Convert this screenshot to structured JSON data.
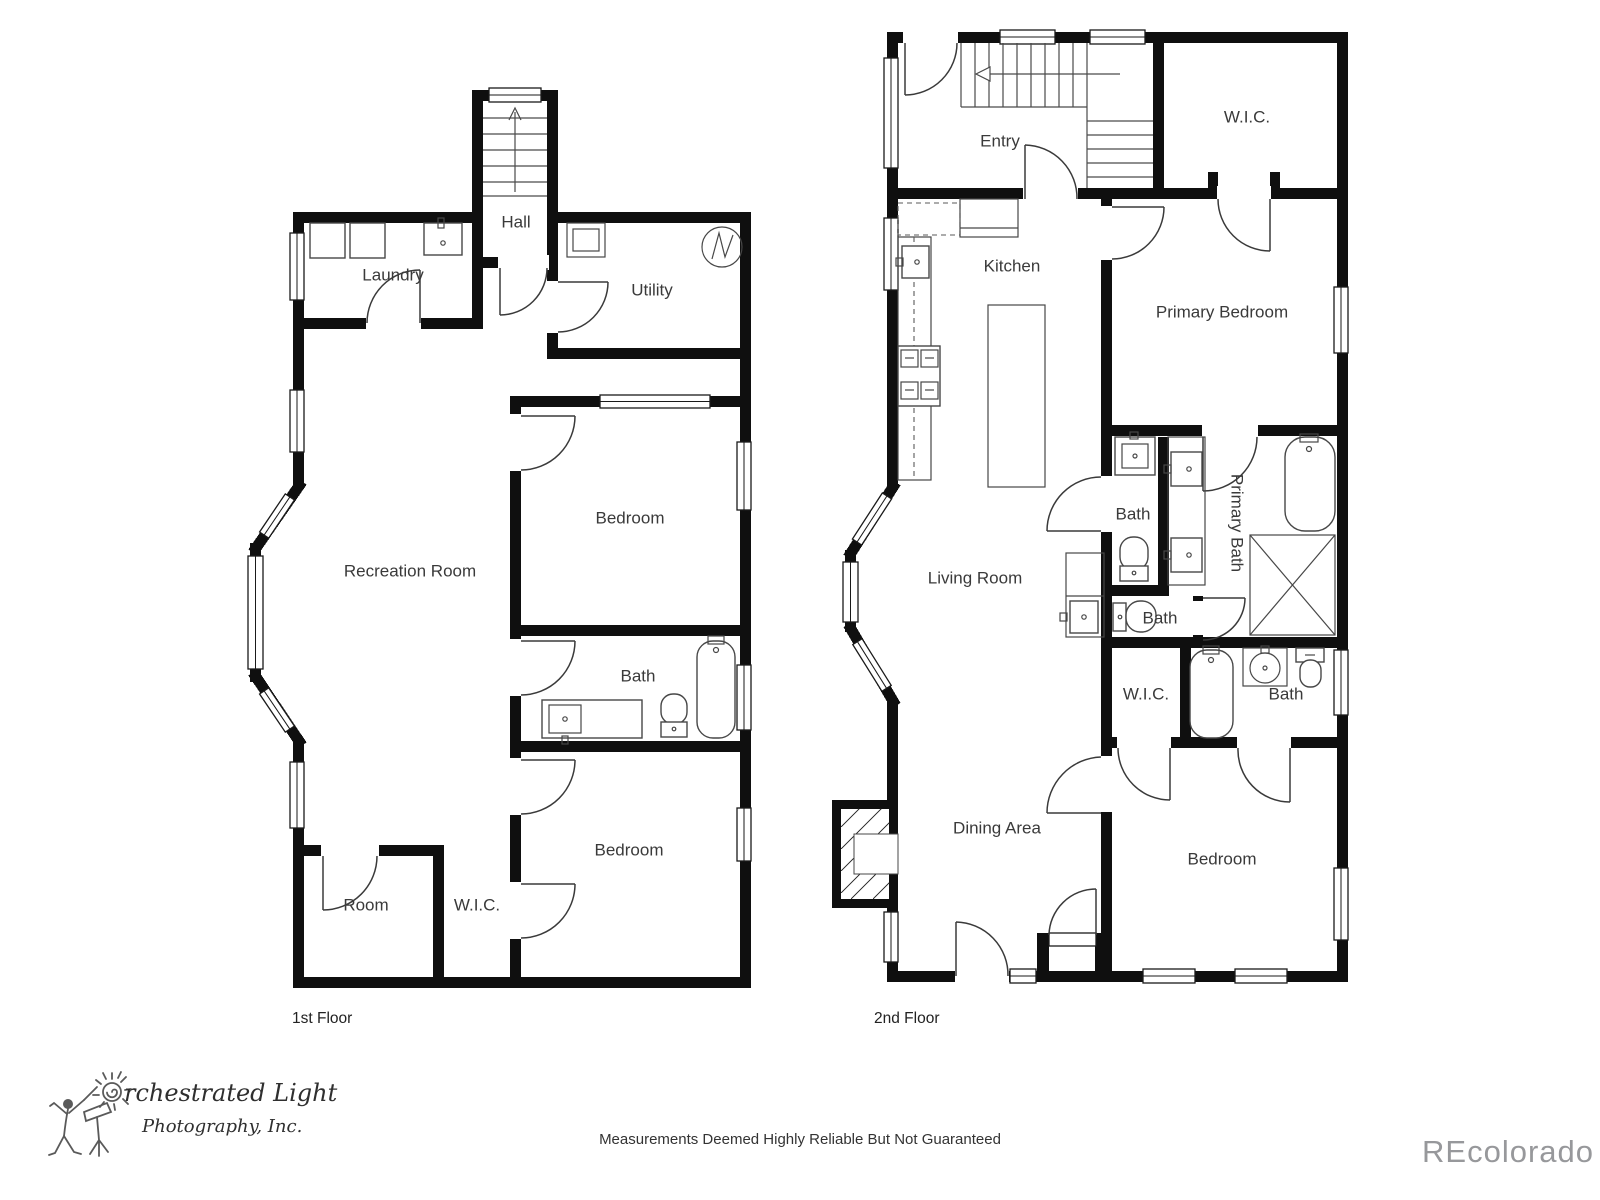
{
  "first_floor": {
    "floor_label": "1st Floor",
    "rooms": {
      "laundry": "Laundry",
      "hall": "Hall",
      "utility": "Utility",
      "bedroom_upper": "Bedroom",
      "recreation_room": "Recreation Room",
      "bath": "Bath",
      "bedroom_lower": "Bedroom",
      "room": "Room",
      "wic": "W.I.C."
    }
  },
  "second_floor": {
    "floor_label": "2nd Floor",
    "rooms": {
      "entry": "Entry",
      "wic_upper": "W.I.C.",
      "kitchen": "Kitchen",
      "primary_bedroom": "Primary Bedroom",
      "bath_hall": "Bath",
      "primary_bath": "Primary Bath",
      "living_room": "Living Room",
      "bath_middle": "Bath",
      "wic_lower": "W.I.C.",
      "bath_lower": "Bath",
      "dining_area": "Dining Area",
      "bedroom": "Bedroom"
    }
  },
  "footer": {
    "logo": {
      "name_full": "Orchestrated Light Photography, Inc.",
      "line1_rest": "rchestrated Light",
      "line2": "Photography, Inc.",
      "o_symbol": "sun-spiral-icon"
    },
    "disclaimer": "Measurements Deemed Highly Reliable But Not Guaranteed",
    "watermark": "REcolorado"
  },
  "colors": {
    "walls": "#0f0f0f",
    "fixture_lines": "#474747",
    "label_text": "#3a3a3a",
    "watermark": "#97989b"
  }
}
